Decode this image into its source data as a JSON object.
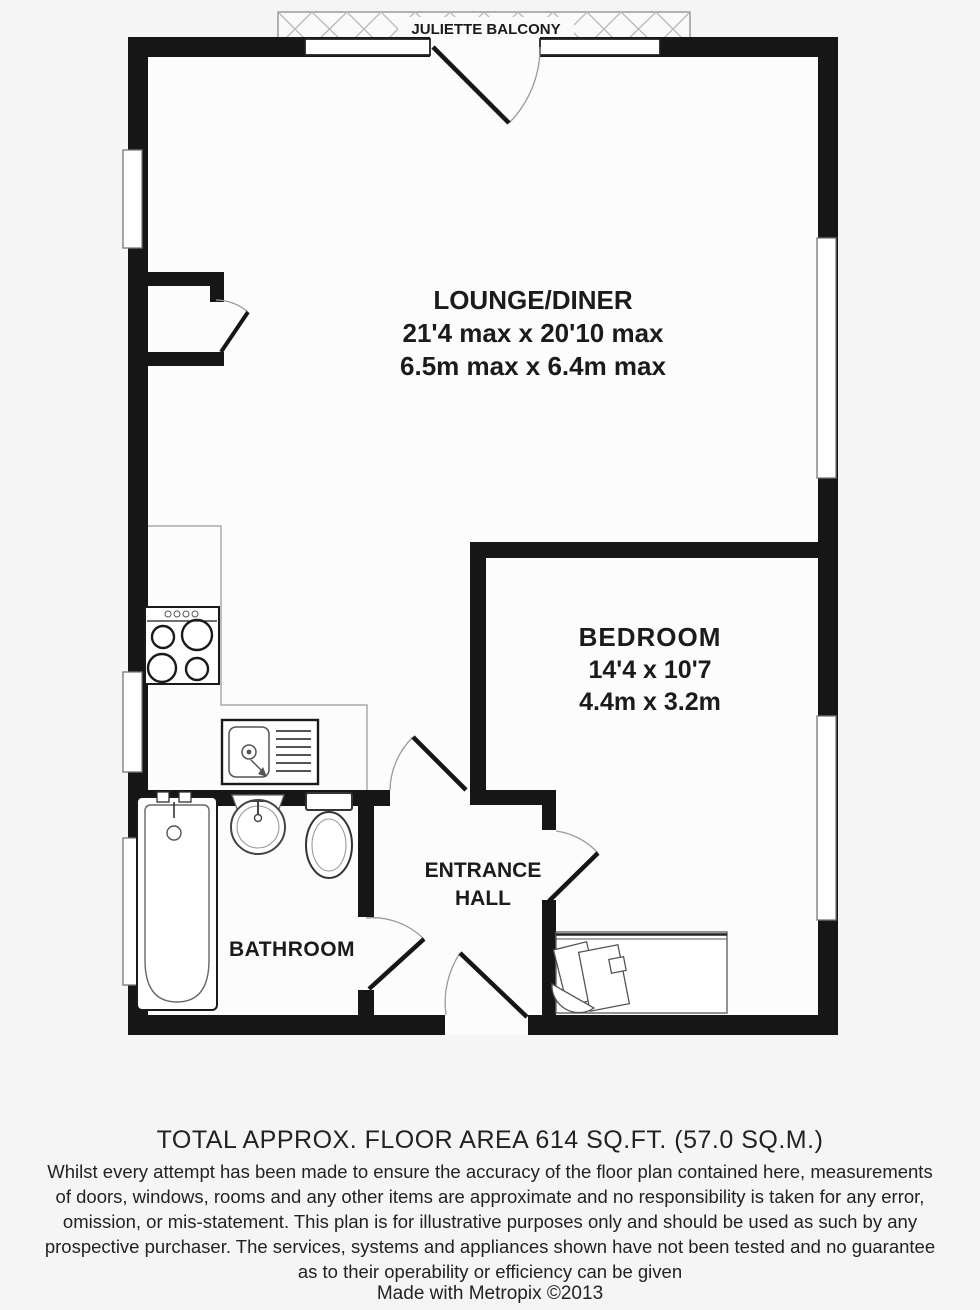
{
  "plan": {
    "balcony_label": "JULIETTE BALCONY",
    "rooms": {
      "lounge": {
        "name": "LOUNGE/DINER",
        "dims_imperial": "21'4 max x 20'10 max",
        "dims_metric": "6.5m max x 6.4m max"
      },
      "bedroom": {
        "name": "BEDROOM",
        "dims_imperial": "14'4 x 10'7",
        "dims_metric": "4.4m x 3.2m"
      },
      "entrance_hall": {
        "name_line1": "ENTRANCE",
        "name_line2": "HALL"
      },
      "bathroom": {
        "name": "BATHROOM"
      }
    },
    "fixtures": [
      "stove",
      "kitchen-sink",
      "bathtub",
      "washbasin",
      "toilet",
      "desk-and-chair"
    ],
    "colors": {
      "wall": "#161616",
      "fixture_line": "#555555",
      "window_fill": "#ffffff",
      "background": "#f5f5f5"
    }
  },
  "footer": {
    "total_area": "TOTAL APPROX. FLOOR AREA 614 SQ.FT. (57.0 SQ.M.)",
    "disclaimer": [
      "Whilst every attempt has been made to ensure the accuracy of the floor plan contained here, measurements",
      "of doors, windows, rooms and any other items are approximate and no responsibility is taken for any error,",
      "omission, or mis-statement. This plan is for illustrative purposes only and should be used as such by any",
      "prospective purchaser. The services, systems and appliances shown have not been tested and no guarantee",
      "as to their operability or efficiency can be given"
    ],
    "credit": "Made with Metropix ©2013"
  }
}
